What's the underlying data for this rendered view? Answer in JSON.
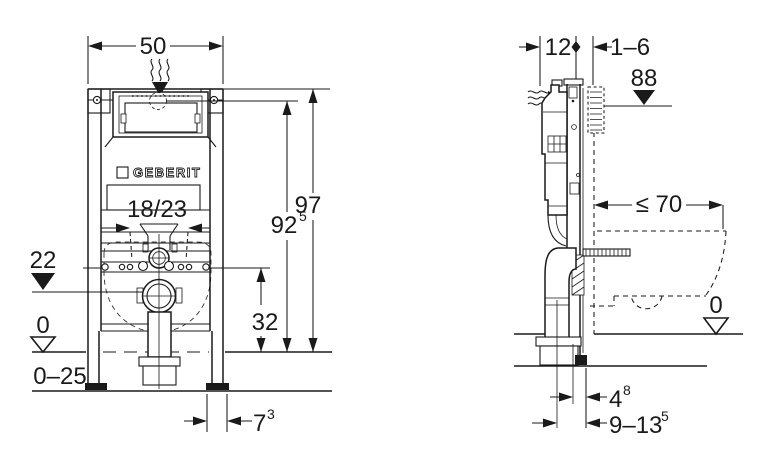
{
  "drawing": {
    "brand": "GEBERIT",
    "colors": {
      "line": "#1a1a1a",
      "background": "#ffffff"
    },
    "front_view": {
      "width": "50",
      "fixing_spacing": "18/23",
      "outlet_level": "22",
      "floor_level": "0",
      "floor_depth_range": "0–25",
      "fixing_height": "32",
      "supply_height": "92",
      "supply_height_sup": "5",
      "frame_height": "97",
      "foot_offset": "7",
      "foot_offset_sup": "3"
    },
    "side_view": {
      "frame_depth": "12",
      "wall_finish_range": "1–6",
      "actuator_level": "88",
      "bowl_depth_max": "≤ 70",
      "floor_level": "0",
      "rail_wall_offset": "4",
      "rail_wall_offset_sup": "8",
      "outlet_wall_range": "9–13",
      "outlet_wall_range_sup": "5"
    }
  }
}
